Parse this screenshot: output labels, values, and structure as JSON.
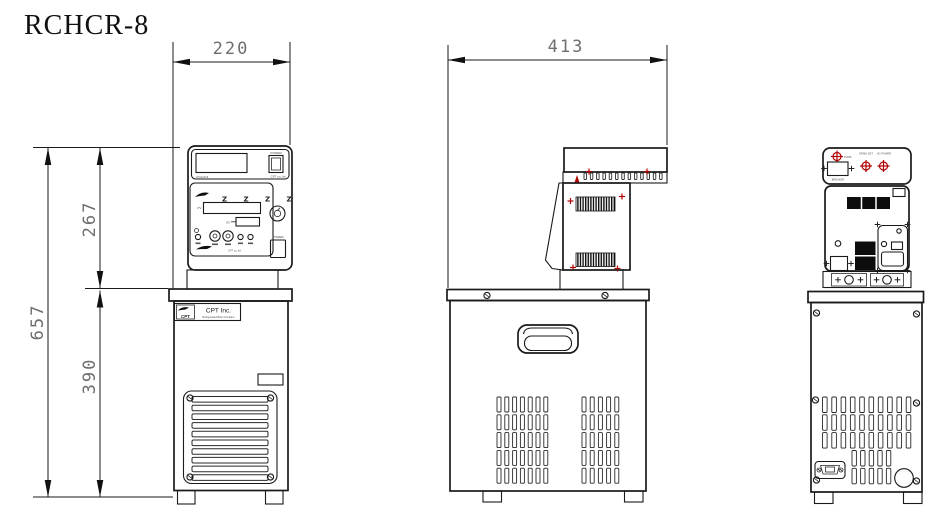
{
  "title": "RCHCR-8",
  "dims": {
    "front_width": "220",
    "side_depth": "413",
    "total_height": "657",
    "head_height": "267",
    "body_height": "390"
  },
  "front": {
    "power_top": "POWER",
    "brand_top": "CPT co.,ltd",
    "display_caption": "RCHCR-8",
    "indicator_row": "Z Z Z Z",
    "pv_label": "PV",
    "sv_label": "SV",
    "power_bottom": "POWER",
    "panel_brand": "CPT co.,ltd",
    "badge_logo_text": "CPT",
    "badge_name": "CPT  Inc.",
    "badge_sub": "Refrigerated Bath Circulator"
  },
  "rear": {
    "pump_label": "PUMP",
    "breaker_label": "BREAKER",
    "drain_label": "DRAIN SET",
    "power_label": "AC POWER"
  },
  "colors": {
    "line": "#1a1a1a",
    "dim_text": "#6e6e6e",
    "marker_red": "#b00000"
  }
}
